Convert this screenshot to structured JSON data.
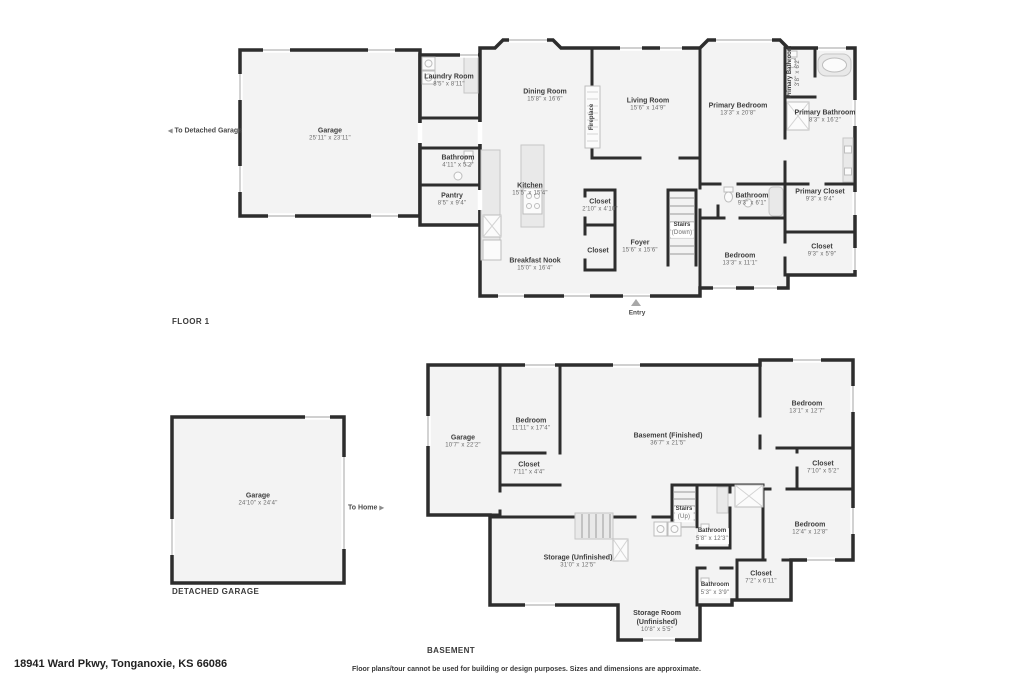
{
  "footer": {
    "address": "18941 Ward Pkwy, Tonganoxie, KS 66086",
    "disclaimer": "Floor plans/tour cannot be used for building or design purposes. Sizes and dimensions are approximate."
  },
  "colors": {
    "wall": "#2d2d2d",
    "room_fill": "#f3f3f3",
    "fixture": "#e9e9e9",
    "window_line": "#b5b5b5",
    "room_name_text": "#3d3d3d",
    "room_dims_text": "#6b6b6b"
  },
  "icons": {
    "to_detached_garage_arrow": "◀",
    "to_home_arrow": "▶",
    "entry_arrow": "▲"
  },
  "floor1": {
    "title": "FLOOR 1",
    "annotations": {
      "to_detached_garage": "To Detached Garage",
      "entry": "Entry"
    },
    "rooms": {
      "garage": {
        "name": "Garage",
        "dims": "25'11\" x 23'11\""
      },
      "laundry_room": {
        "name": "Laundry Room",
        "dims": "8'5\" x 8'11\""
      },
      "dining_room": {
        "name": "Dining Room",
        "dims": "15'8\" x 16'6\""
      },
      "living_room": {
        "name": "Living Room",
        "dims": "15'6\" x 14'9\""
      },
      "fireplace": {
        "name": "Fireplace"
      },
      "kitchen": {
        "name": "Kitchen",
        "dims": "15'5\" x 15'4\""
      },
      "bathroom_hall": {
        "name": "Bathroom",
        "dims": "4'11\" x 5'2\""
      },
      "pantry": {
        "name": "Pantry",
        "dims": "8'5\" x 9'4\""
      },
      "closet_hall": {
        "name": "Closet",
        "dims": "2'10\" x 4'10\""
      },
      "closet_foyer": {
        "name": "Closet"
      },
      "breakfast_nook": {
        "name": "Breakfast Nook",
        "dims": "15'0\" x 16'4\""
      },
      "foyer": {
        "name": "Foyer",
        "dims": "15'6\" x 15'6\""
      },
      "stairs": {
        "name": "Stairs",
        "dims": "(Down)"
      },
      "primary_bedroom": {
        "name": "Primary Bedroom",
        "dims": "13'3\" x 20'8\""
      },
      "primary_bathroom_small": {
        "name": "Primary Bathroom",
        "dims": "3'8\" x 6'2\""
      },
      "primary_bathroom": {
        "name": "Primary Bathroom",
        "dims": "8'3\" x 16'2\""
      },
      "bathroom": {
        "name": "Bathroom",
        "dims": "9'3\" x 6'1\""
      },
      "primary_closet": {
        "name": "Primary Closet",
        "dims": "9'3\" x 9'4\""
      },
      "bedroom": {
        "name": "Bedroom",
        "dims": "13'3\" x 11'1\""
      },
      "closet_bedroom": {
        "name": "Closet",
        "dims": "9'3\" x 5'9\""
      }
    }
  },
  "detached_garage": {
    "title": "DETACHED GARAGE",
    "annotations": {
      "to_home": "To Home"
    },
    "rooms": {
      "garage": {
        "name": "Garage",
        "dims": "24'10\" x 24'4\""
      }
    }
  },
  "basement": {
    "title": "BASEMENT",
    "rooms": {
      "garage": {
        "name": "Garage",
        "dims": "10'7\" x 22'2\""
      },
      "bedroom_left": {
        "name": "Bedroom",
        "dims": "11'11\" x 17'4\""
      },
      "closet_left": {
        "name": "Closet",
        "dims": "7'11\" x 4'4\""
      },
      "basement_finished": {
        "name": "Basement (Finished)",
        "dims": "36'7\" x 21'5\""
      },
      "bedroom_upper_right": {
        "name": "Bedroom",
        "dims": "13'1\" x 12'7\""
      },
      "closet_upper_right": {
        "name": "Closet",
        "dims": "7'10\" x 5'2\""
      },
      "stairs": {
        "name": "Stairs",
        "dims": "(Up)"
      },
      "bathroom_upper": {
        "name": "Bathroom",
        "dims": "5'8\" x 12'3\""
      },
      "bedroom_lower_right": {
        "name": "Bedroom",
        "dims": "12'4\" x 12'8\""
      },
      "closet_lower_right": {
        "name": "Closet",
        "dims": "7'2\" x 6'11\""
      },
      "bathroom_lower": {
        "name": "Bathroom",
        "dims": "5'3\" x 3'9\""
      },
      "storage_unfinished": {
        "name": "Storage (Unfinished)",
        "dims": "31'0\" x 12'5\""
      },
      "storage_room": {
        "name": "Storage Room (Unfinished)",
        "dims": "10'8\" x 5'5\""
      }
    }
  }
}
